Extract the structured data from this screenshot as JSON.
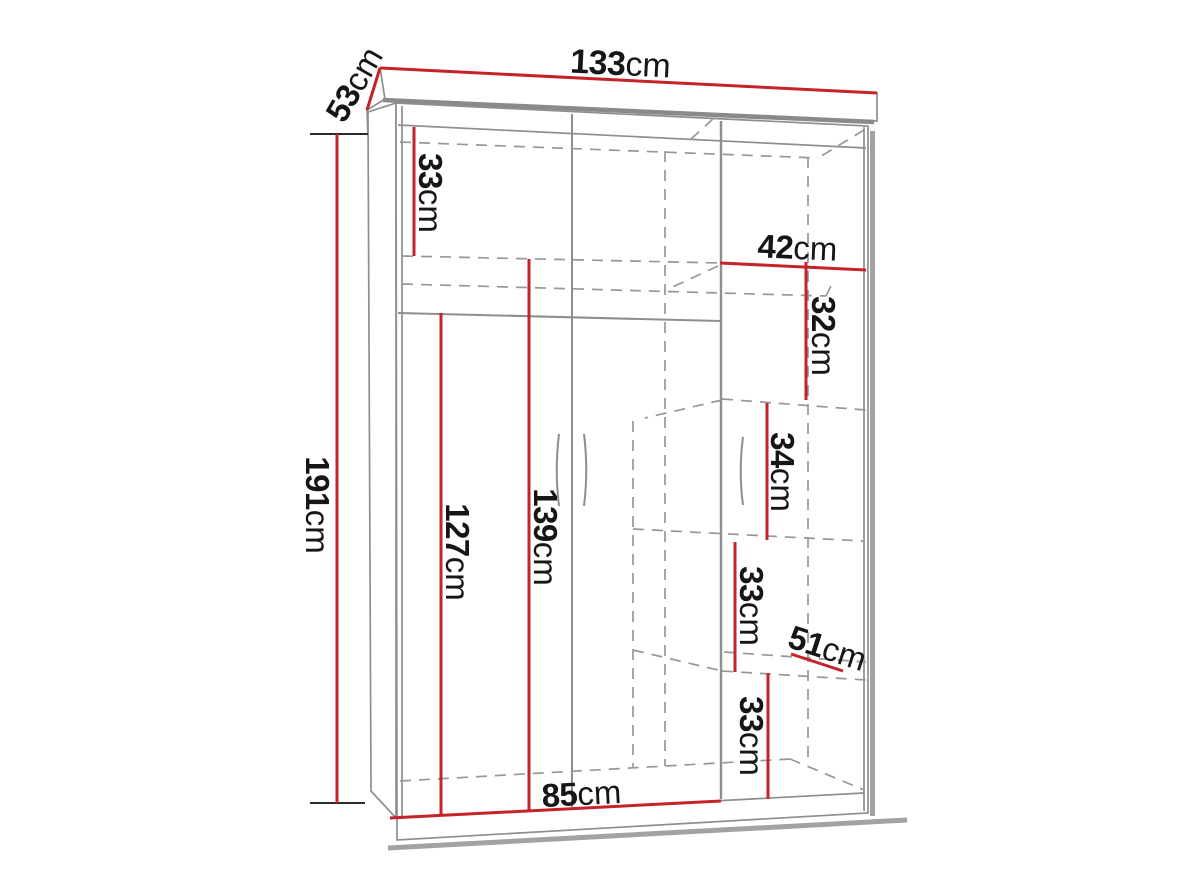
{
  "diagram": {
    "type": "wardrobe-dimension-drawing",
    "unit": "cm",
    "colors": {
      "dimension_line": "#c5222a",
      "structure_line": "#8e8e8e",
      "label_text": "#161616",
      "background": "#ffffff"
    },
    "dims": [
      {
        "value": "133",
        "unit": "cm"
      },
      {
        "value": "53",
        "unit": "cm"
      },
      {
        "value": "191",
        "unit": "cm"
      },
      {
        "value": "33",
        "unit": "cm"
      },
      {
        "value": "42",
        "unit": "cm"
      },
      {
        "value": "32",
        "unit": "cm"
      },
      {
        "value": "34",
        "unit": "cm"
      },
      {
        "value": "33",
        "unit": "cm"
      },
      {
        "value": "51",
        "unit": "cm"
      },
      {
        "value": "33",
        "unit": "cm"
      },
      {
        "value": "127",
        "unit": "cm"
      },
      {
        "value": "139",
        "unit": "cm"
      },
      {
        "value": "85",
        "unit": "cm"
      }
    ]
  }
}
